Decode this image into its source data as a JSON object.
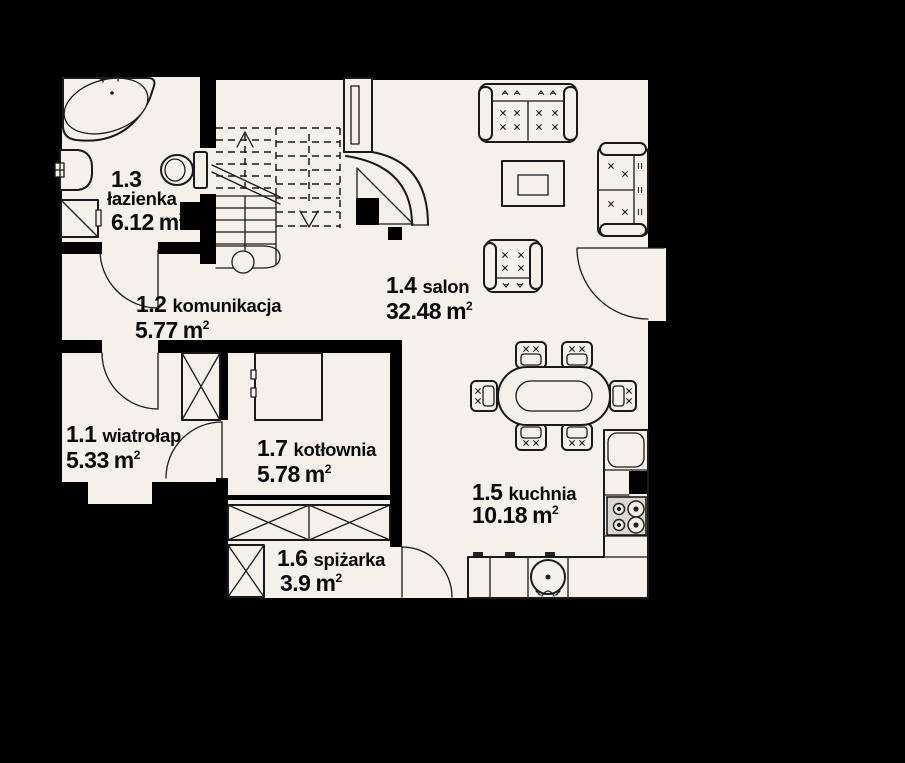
{
  "plan": {
    "type": "floor-plan",
    "units": {
      "m": "m",
      "sup": "2"
    },
    "rooms": [
      {
        "number": "1.1",
        "name": "wiatrołap",
        "area": "5.33"
      },
      {
        "number": "1.2",
        "name": "komunikacja",
        "area": "5.77"
      },
      {
        "number": "1.3",
        "name": "łazienka",
        "area": "6.12"
      },
      {
        "number": "1.4",
        "name": "salon",
        "area": "32.48"
      },
      {
        "number": "1.5",
        "name": "kuchnia",
        "area": "10.18"
      },
      {
        "number": "1.6",
        "name": "spiżarka",
        "area": "3.9"
      },
      {
        "number": "1.7",
        "name": "kotłownia",
        "area": "5.78"
      }
    ],
    "colors": {
      "background": "#000000",
      "floor": "#f5f0e9",
      "wall": "#000000",
      "line": "#1a1a1a"
    },
    "fixtures": [
      "corner-bathtub",
      "washbasin",
      "washing-machine",
      "toilet",
      "stairs-up",
      "chimney",
      "corner-fireplace",
      "sofa-3-seat",
      "sofa-2-seat",
      "armchair",
      "coffee-table",
      "dining-table",
      "dining-chair",
      "wardrobe",
      "boiler",
      "pantry-cabinets",
      "fridge",
      "stove-4-burner",
      "kitchen-counter",
      "kitchen-sink",
      "door-swing"
    ]
  }
}
